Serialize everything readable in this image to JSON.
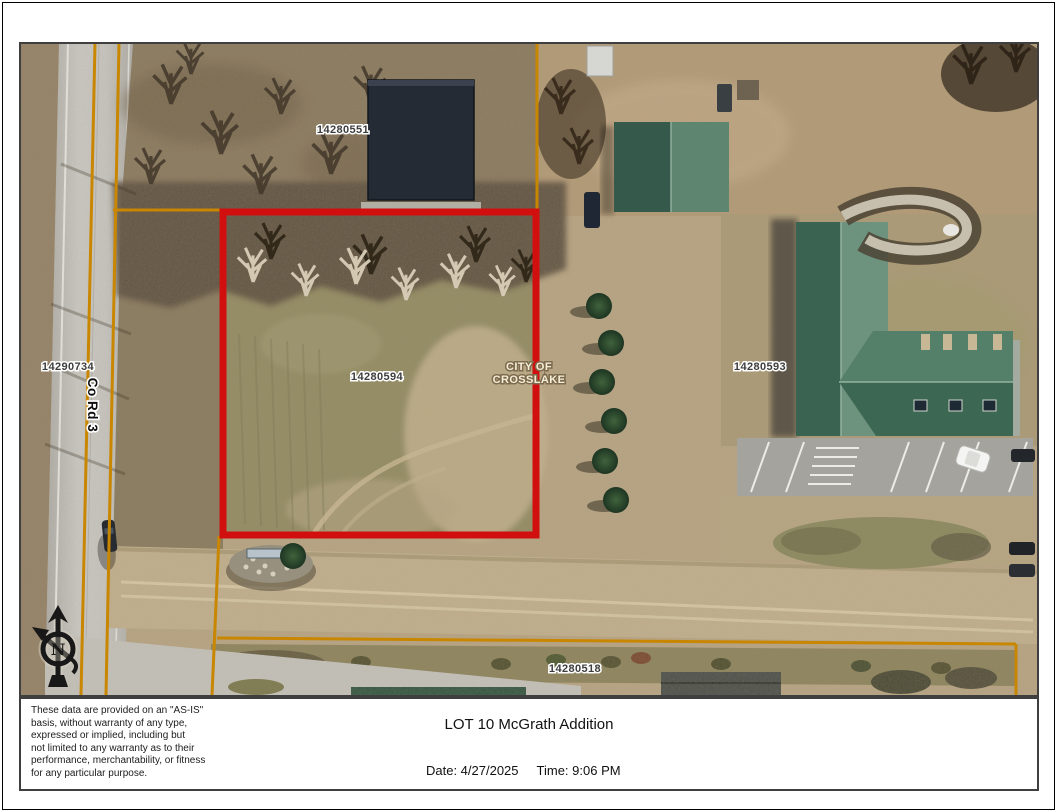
{
  "map": {
    "parcels": {
      "top": "14280551",
      "west": "14290734",
      "subject": "14280594",
      "east": "14280593",
      "south": "14280518"
    },
    "road_label": "Co Rd 3",
    "city_label_line1": "CITY OF",
    "city_label_line2": "CROSSLAKE",
    "north_arrow_letter": "N",
    "icons": {
      "north_arrow": "north-arrow-compass"
    },
    "colors": {
      "parcel_boundary": "#c98600",
      "subject_highlight": "#d10f0f"
    }
  },
  "footer": {
    "disclaimer_lines": [
      "These data are provided on an \"AS-IS\"",
      "basis, without warranty of any type,",
      "expressed or implied, including but",
      "not limited to any warranty as to their",
      "performance, merchantability, or fitness",
      "for any particular purpose."
    ],
    "title": "LOT 10 McGrath Addition",
    "date": "Date: 4/27/2025",
    "time": "Time: 9:06 PM"
  }
}
